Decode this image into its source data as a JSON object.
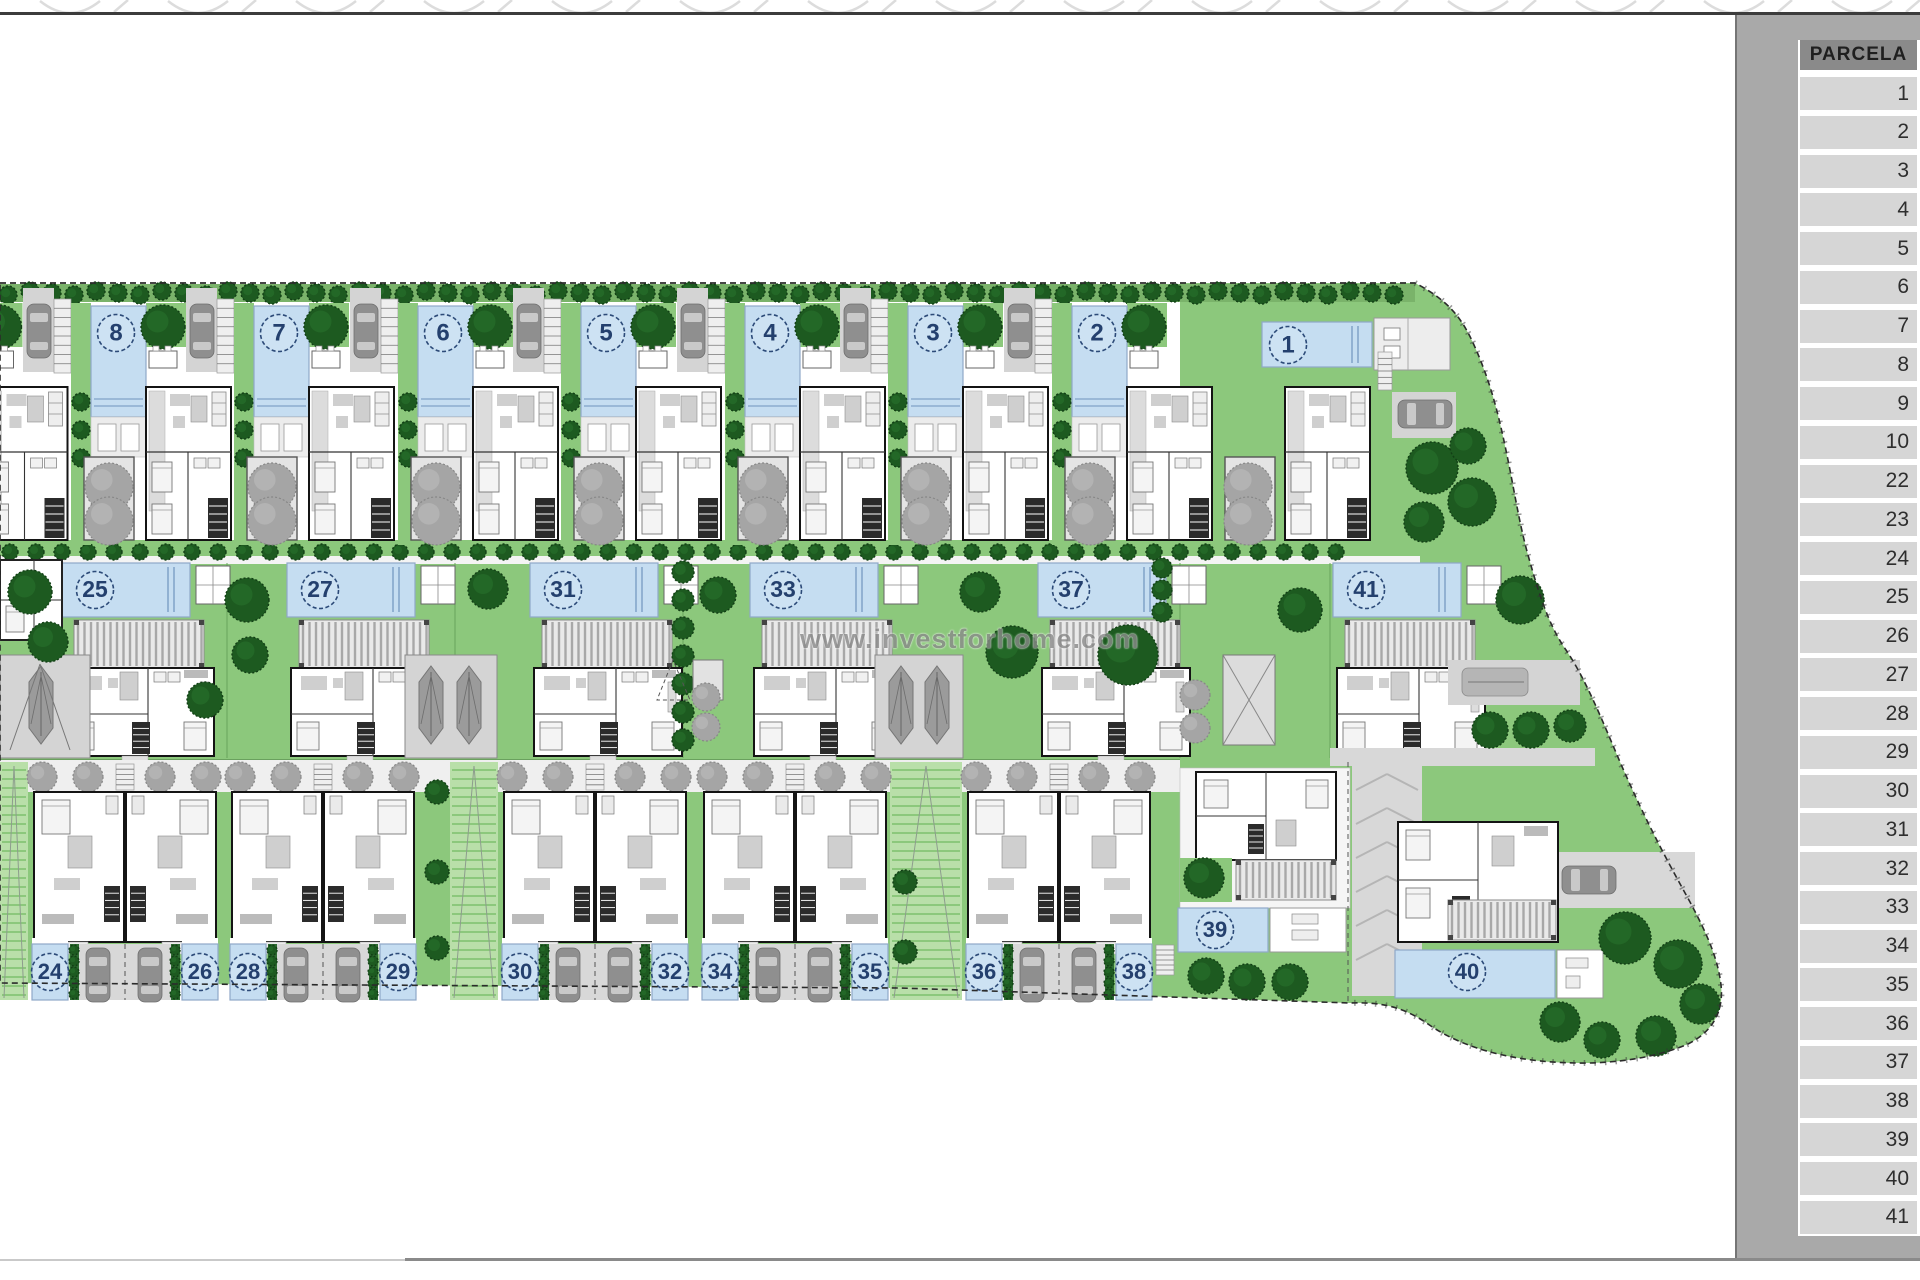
{
  "sidebar": {
    "header": "PARCELA",
    "rows": [
      "1",
      "2",
      "3",
      "4",
      "5",
      "6",
      "7",
      "8",
      "9",
      "10",
      "22",
      "23",
      "24",
      "25",
      "26",
      "27",
      "28",
      "29",
      "30",
      "31",
      "32",
      "33",
      "34",
      "35",
      "36",
      "37",
      "38",
      "39",
      "40",
      "41"
    ]
  },
  "watermark": "www.investforhome.com",
  "plan": {
    "top_villas": [
      {
        "label": "8",
        "cx": 116
      },
      {
        "label": "7",
        "cx": 279
      },
      {
        "label": "6",
        "cx": 443
      },
      {
        "label": "5",
        "cx": 606
      },
      {
        "label": "4",
        "cx": 770
      },
      {
        "label": "3",
        "cx": 933
      },
      {
        "label": "2",
        "cx": 1097
      }
    ],
    "villa1": {
      "label": "1",
      "cx": 1288,
      "cy": 345
    },
    "middle_villas": [
      {
        "label": "25",
        "pool_x": 62
      },
      {
        "label": "27",
        "pool_x": 287
      },
      {
        "label": "31",
        "pool_x": 530
      },
      {
        "label": "33",
        "pool_x": 750
      },
      {
        "label": "37",
        "pool_x": 1038
      },
      {
        "label": "41",
        "pool_x": 1333
      }
    ],
    "duplexes": [
      {
        "cell_x": 28,
        "left": "24",
        "right": "26"
      },
      {
        "cell_x": 226,
        "left": "28",
        "right": "29"
      },
      {
        "cell_x": 498,
        "left": "30",
        "right": "32"
      },
      {
        "cell_x": 698,
        "left": "34",
        "right": "35"
      },
      {
        "cell_x": 962,
        "left": "36",
        "right": "38"
      }
    ],
    "villa39": {
      "label": "39",
      "cx": 1215,
      "cy": 930
    },
    "villa40": {
      "label": "40",
      "cx": 1467,
      "cy": 972
    }
  },
  "colors": {
    "site_green": "#8cc87c",
    "pale_green": "#b9dfa9",
    "hedge_green": "#7ab36a",
    "tree_dark": "#1d5a20",
    "pool_blue": "#c5ddf1",
    "pool_edge": "#8fa8c8",
    "badge_navy": "#24406e",
    "gray_tree": "#a5a5a5",
    "drive_gray": "#d4d4d4",
    "car_gray": "#8f8f8f",
    "panel_gray": "#a9a9a9",
    "cell_gray": "#d6d6d6",
    "header_gray": "#8a8a8a"
  }
}
